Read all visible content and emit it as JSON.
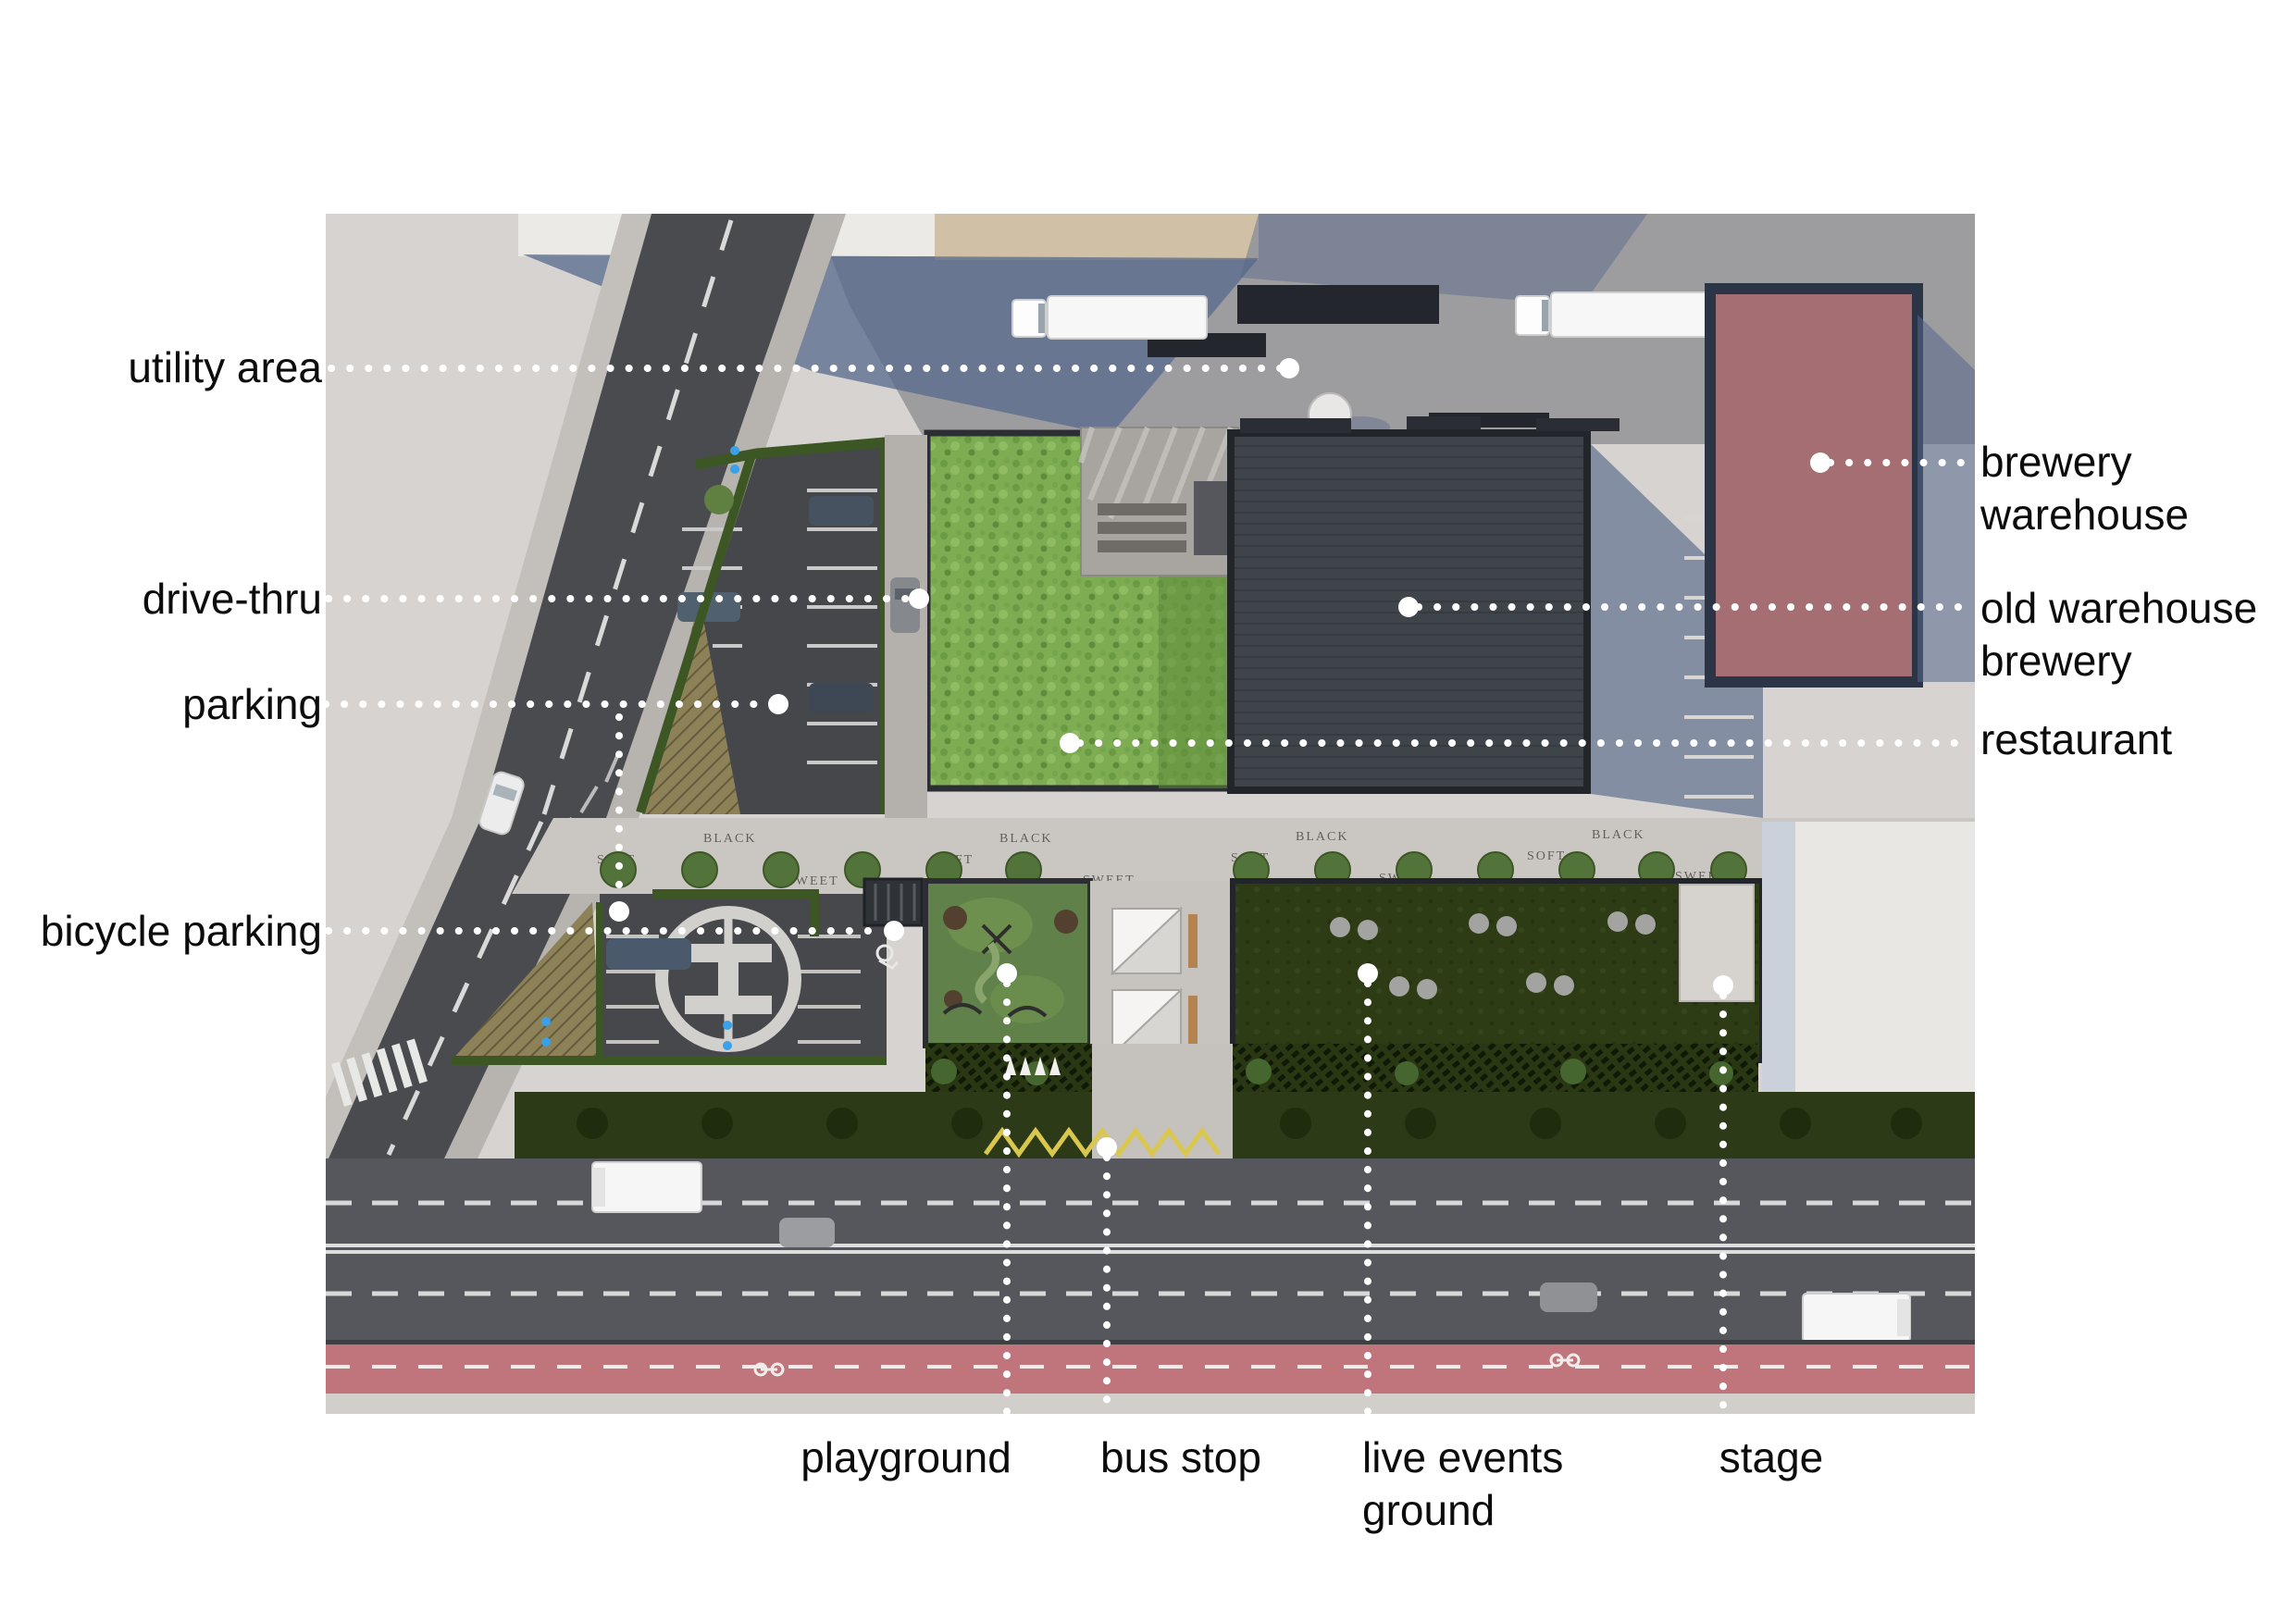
{
  "page": {
    "background": "#ffffff",
    "type": "annotated architectural site plan (aerial render)"
  },
  "labels": {
    "left": [
      {
        "id": "utility-area",
        "text": "utility area"
      },
      {
        "id": "drive-thru",
        "text": "drive-thru"
      },
      {
        "id": "parking",
        "text": "parking"
      },
      {
        "id": "bicycle-parking",
        "text": "bicycle parking"
      }
    ],
    "right": [
      {
        "id": "brewery-warehouse",
        "lines": [
          "brewery",
          "warehouse"
        ]
      },
      {
        "id": "old-warehouse-brewery",
        "lines": [
          "old warehouse",
          "brewery"
        ]
      },
      {
        "id": "restaurant",
        "lines": [
          "restaurant"
        ]
      }
    ],
    "bottom": [
      {
        "id": "playground",
        "lines": [
          "playground"
        ]
      },
      {
        "id": "bus-stop",
        "lines": [
          "bus stop"
        ]
      },
      {
        "id": "live-events-ground",
        "lines": [
          "live events",
          "ground"
        ]
      },
      {
        "id": "stage",
        "lines": [
          "stage"
        ]
      }
    ]
  },
  "ground_markings": {
    "promenade_words": [
      "BLACK",
      "SOFT",
      "SWEET"
    ]
  },
  "leader_style": {
    "color": "#ffffff",
    "style": "dotted with round endpoint dot"
  },
  "colors": {
    "label_text": "#0c0c0c",
    "asphalt_road": "#4a4b4f",
    "main_road": "#56575c",
    "bike_lane_red": "#c0747c",
    "promenade": "#cac6c2",
    "utility_yard": "#9d9c9e",
    "warehouse_roof": "#3f434a",
    "brewery_warehouse_red": "#a56e72",
    "restaurant_green_roof": "#7dac53",
    "events_lawn": "#2e3c16",
    "playground_green": "#60824a",
    "hedge_green": "#3c5624",
    "shadow_blue": "#57698c"
  }
}
